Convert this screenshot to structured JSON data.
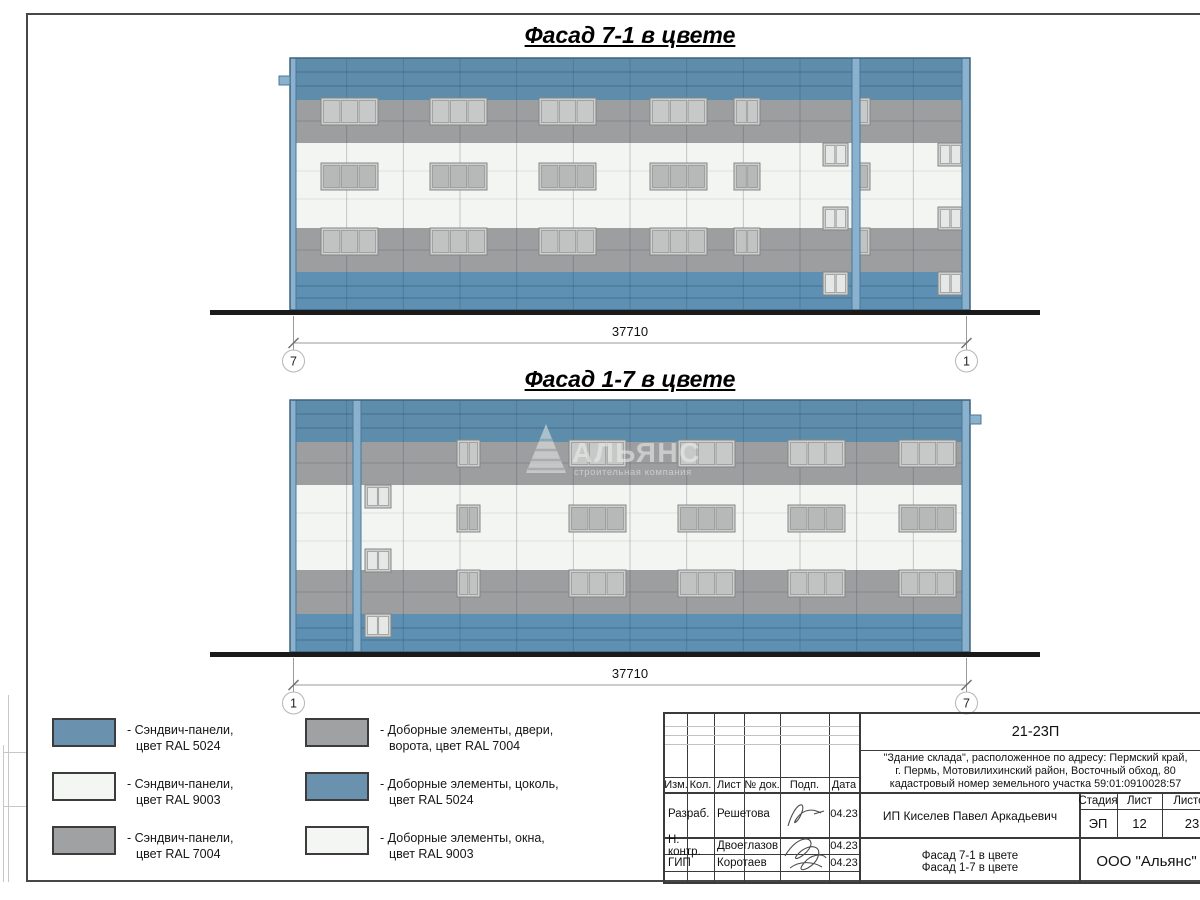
{
  "facades": [
    {
      "title": "Фасад 7-1 в цвете",
      "dim_label": "37710",
      "bubble_left": "7",
      "bubble_right": "1",
      "pilaster": {
        "x": 562,
        "w": 8
      },
      "tab": {
        "x": -11,
        "y": 18,
        "w": 11,
        "h": 9
      },
      "main_cols": [
        {
          "x": 31,
          "w": 57,
          "panes": 3
        },
        {
          "x": 140,
          "w": 57,
          "panes": 3
        },
        {
          "x": 249,
          "w": 57,
          "panes": 3
        },
        {
          "x": 360,
          "w": 57,
          "panes": 3
        },
        {
          "x": 444,
          "w": 26,
          "panes": 2
        },
        {
          "x": 567,
          "w": 13,
          "panes": 1
        }
      ],
      "stair_cols": [
        {
          "x": 533,
          "w": 25
        },
        {
          "x": 648,
          "w": 25
        }
      ],
      "watermark": false
    },
    {
      "title": "Фасад 1-7 в цвете",
      "dim_label": "37710",
      "bubble_left": "1",
      "bubble_right": "7",
      "pilaster": {
        "x": 63,
        "w": 8
      },
      "tab": {
        "x": 680,
        "y": 15,
        "w": 11,
        "h": 9
      },
      "main_cols": [
        {
          "x": 167,
          "w": 23,
          "panes": 2
        },
        {
          "x": 279,
          "w": 57,
          "panes": 3
        },
        {
          "x": 388,
          "w": 57,
          "panes": 3
        },
        {
          "x": 498,
          "w": 57,
          "panes": 3
        },
        {
          "x": 609,
          "w": 57,
          "panes": 3
        }
      ],
      "stair_cols": [
        {
          "x": 75,
          "w": 26
        }
      ],
      "watermark": true
    }
  ],
  "facade_common": {
    "width": 680,
    "height": 252,
    "bands": [
      {
        "name": "parapet-panels",
        "color": "blue",
        "y": 0,
        "h": 42,
        "joints": [
          14,
          28
        ],
        "joint_color": "blue_joint"
      },
      {
        "name": "upper-gray-panels",
        "color": "gray",
        "y": 42,
        "h": 43,
        "joints": [
          63
        ],
        "joint_color": "gray_joint"
      },
      {
        "name": "middle-white-panels",
        "color": "white",
        "y": 85,
        "h": 85,
        "joints": [
          113,
          141
        ],
        "joint_color": "white_joint"
      },
      {
        "name": "lower-gray-panels",
        "color": "gray",
        "y": 170,
        "h": 44,
        "joints": [
          192
        ],
        "joint_color": "gray_joint"
      },
      {
        "name": "plinth-panels",
        "color": "plinth",
        "y": 214,
        "h": 38,
        "joints": [
          228,
          240
        ],
        "joint_color": "blue_joint"
      }
    ],
    "edge_strips": [
      {
        "x": 0,
        "w": 6
      },
      {
        "x": 672,
        "w": 8
      }
    ],
    "main_rows": [
      {
        "y": 40,
        "h": 27,
        "pane": "win_pane_r1"
      },
      {
        "y": 105,
        "h": 27,
        "pane": "win_pane_r2"
      },
      {
        "y": 170,
        "h": 27,
        "pane": "win_pane_r3"
      }
    ],
    "stair_rows": [
      {
        "y": 85,
        "h": 23
      },
      {
        "y": 149,
        "h": 23
      },
      {
        "y": 214,
        "h": 23
      }
    ]
  },
  "colors": {
    "blue": "#5e8dac",
    "plinth": "#5d90b2",
    "gray": "#9c9e9f",
    "white": "#f2f5f1",
    "blue_joint": "#46708c",
    "gray_joint": "#86898a",
    "white_joint": "#dde1dd",
    "pilaster": "#8ab1cd",
    "pilaster_edge": "#4c7898",
    "outline": "#3f637c",
    "win_frame": "#ccd0cf",
    "win_frame_edge": "#848786",
    "win_mullion": "#8f9291",
    "win_pane_r1": "#c6c9c8",
    "win_pane_r2": "#b6b9b8",
    "win_pane_r3": "#c0c3c2",
    "win_pane_stair": "#e6e8e7",
    "ground": "#1b1b1b",
    "dim_line": "#9a9a9a",
    "tick": "#6f6f6f",
    "bubble_stroke": "#b5b5b5",
    "watermark": "#e9ece9"
  },
  "watermark": {
    "brand": "АЛЬЯНС",
    "subtitle": "строительная компания"
  },
  "legend": {
    "colors": {
      "blue": "#6a92ae",
      "white": "#f3f6f2",
      "gray": "#9fa1a2"
    },
    "left": [
      {
        "swatch": "blue",
        "lines": [
          "- Сэндвич-панели,",
          "цвет RAL 5024"
        ]
      },
      {
        "swatch": "white",
        "lines": [
          "- Сэндвич-панели,",
          "цвет RAL 9003"
        ]
      },
      {
        "swatch": "gray",
        "lines": [
          "- Сэндвич-панели,",
          "цвет RAL 7004"
        ]
      }
    ],
    "right": [
      {
        "swatch": "gray",
        "lines": [
          "- Доборные элементы, двери,",
          "ворота, цвет RAL 7004"
        ]
      },
      {
        "swatch": "blue",
        "lines": [
          "- Доборные элементы, цоколь,",
          "цвет RAL 5024"
        ]
      },
      {
        "swatch": "white",
        "lines": [
          "- Доборные элементы, окна,",
          "цвет RAL 9003"
        ]
      }
    ]
  },
  "title_block": {
    "doc_number": "21-23П",
    "desc": [
      "\"Здание склада\", расположенное по адресу: Пермский край,",
      "г. Пермь, Мотовилихинский район, Восточный обход, 80",
      "кадастровый номер земельного участка 59:01:0910028:57"
    ],
    "cols": [
      "Изм.",
      "Кол.",
      "Лист",
      "№ док.",
      "Подп.",
      "Дата"
    ],
    "rows": [
      {
        "role": "Разраб.",
        "name": "Решетова",
        "date": "04.23"
      },
      {
        "role": "Н. контр.",
        "name": "Двоеглазов",
        "date": "04.23"
      },
      {
        "role": "ГИП",
        "name": "Коротаев",
        "date": "04.23"
      }
    ],
    "client": "ИП Киселев Павел Аркадьевич",
    "doc_title": [
      "Фасад 7-1 в цвете",
      "Фасад 1-7 в цвете"
    ],
    "stage_label": "Стадия",
    "stage_value": "ЭП",
    "sheet_label": "Лист",
    "sheet_value": "12",
    "sheets_label": "Листов",
    "sheets_value": "23",
    "company": "ООО \"Альянс\""
  }
}
